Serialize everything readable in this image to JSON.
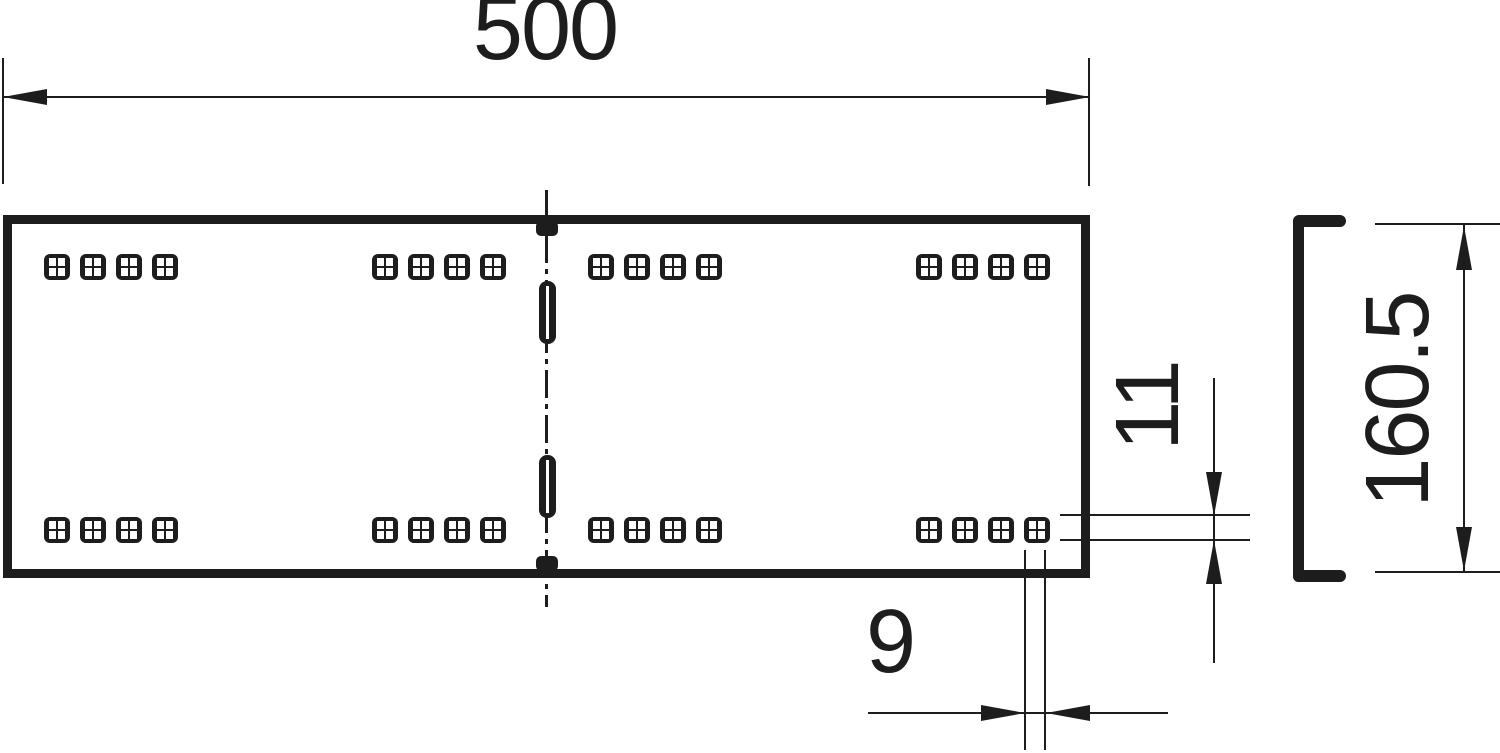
{
  "drawing": {
    "type": "technical-dimension-drawing",
    "description": "Cable tray straight connector, plan view with perforations and C-profile side view",
    "dimensions": {
      "width_label": "500",
      "slot_height_label": "11",
      "slot_width_label": "9",
      "side_height_label": "160.5"
    },
    "plan_view": {
      "hole_rows": 2,
      "row_y": [
        254,
        517
      ],
      "hole_groups_x": [
        44,
        372,
        588,
        916
      ],
      "holes_per_group": 4,
      "hole_pitch": 36,
      "hole_size": 26,
      "slots_y": [
        281,
        455
      ]
    },
    "colors": {
      "ink": "#1d1d1d",
      "background": "#ffffff"
    }
  }
}
